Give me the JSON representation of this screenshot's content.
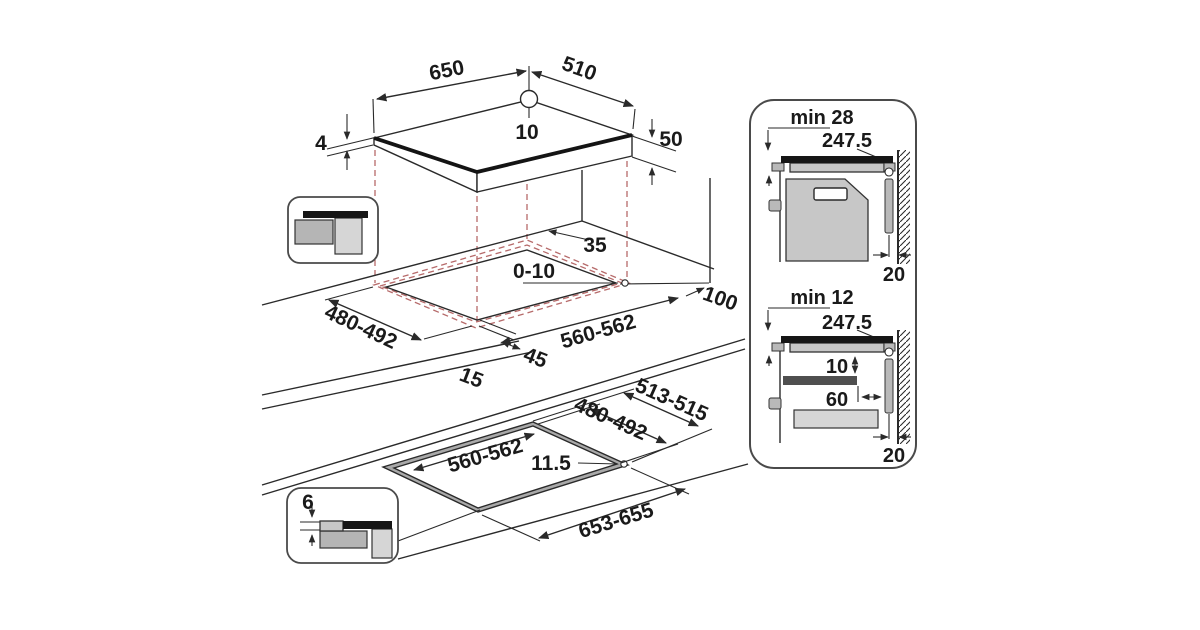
{
  "colors": {
    "line": "#2a2a2a",
    "projection_dash": "#b66a6a",
    "hob_glass": "#161616",
    "cabinet_grey": "#c7c7c7"
  },
  "hob_view": {
    "width": "650",
    "depth": "510",
    "glass_thickness": "4",
    "total_height": "50",
    "hole_diameter": "10"
  },
  "worktop_view": {
    "rear_clearance": "35",
    "edge_overlap": "0-10",
    "cutout_depth": "480-492",
    "cutout_width": "560-562",
    "front_clearance": "45",
    "front_gap": "15",
    "side_clearance": "100"
  },
  "flush_view": {
    "outer_depth": "513-515",
    "inner_depth": "480-492",
    "inner_width": "560-562",
    "ledge_width": "11.5",
    "outer_width": "653-655",
    "recess_depth": "6"
  },
  "oven_section": {
    "min_clearance": "min 28",
    "half_width": "247.5",
    "wall_gap": "20"
  },
  "drawer_section": {
    "min_clearance": "min 12",
    "half_width": "247.5",
    "shelf_gap": "10",
    "shelf_inset": "60",
    "wall_gap": "20"
  }
}
